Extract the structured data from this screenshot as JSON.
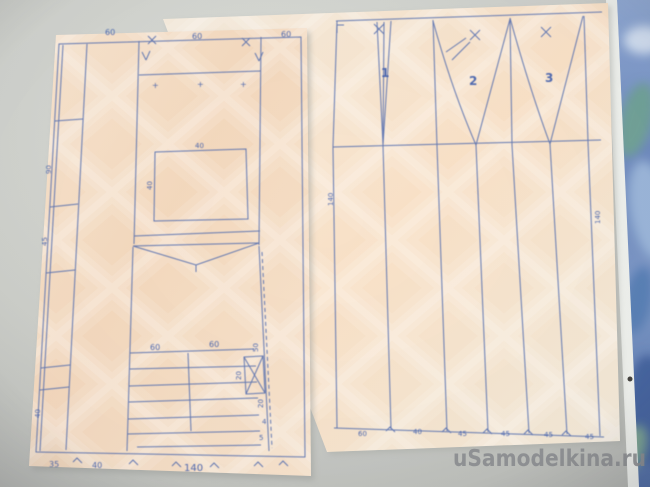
{
  "watermark": "uSamodelkina.ru",
  "left_sheet": {
    "top_dim_labels": [
      "60",
      "60",
      "60"
    ],
    "plus_marks": [
      "+",
      "+",
      "+"
    ],
    "window_top_label": "40",
    "window_side_label": "40",
    "strip_labels": [
      "90",
      "45",
      "40"
    ],
    "shelf_labels": [
      "60",
      "60"
    ],
    "right_col_labels": [
      "50",
      "20",
      "20",
      "4",
      "5"
    ],
    "bottom_dim_labels": [
      "35",
      "40",
      "140"
    ]
  },
  "right_sheet": {
    "dart_numbers": [
      "1",
      "2",
      "3"
    ],
    "left_length_label": "140",
    "right_length_label": "140",
    "bottom_dim_labels": [
      "60",
      "40",
      "45",
      "45",
      "45",
      "45"
    ]
  },
  "colors": {
    "ink": "#4a66ad",
    "ink_dark": "#3d5cac",
    "paper_left": "#f4dcc3",
    "paper_right": "#f6e6d2",
    "table": "#cdcfcb",
    "wallpaper_blue": "#6c8cc6",
    "watermark_gray": "#8b8d90"
  }
}
